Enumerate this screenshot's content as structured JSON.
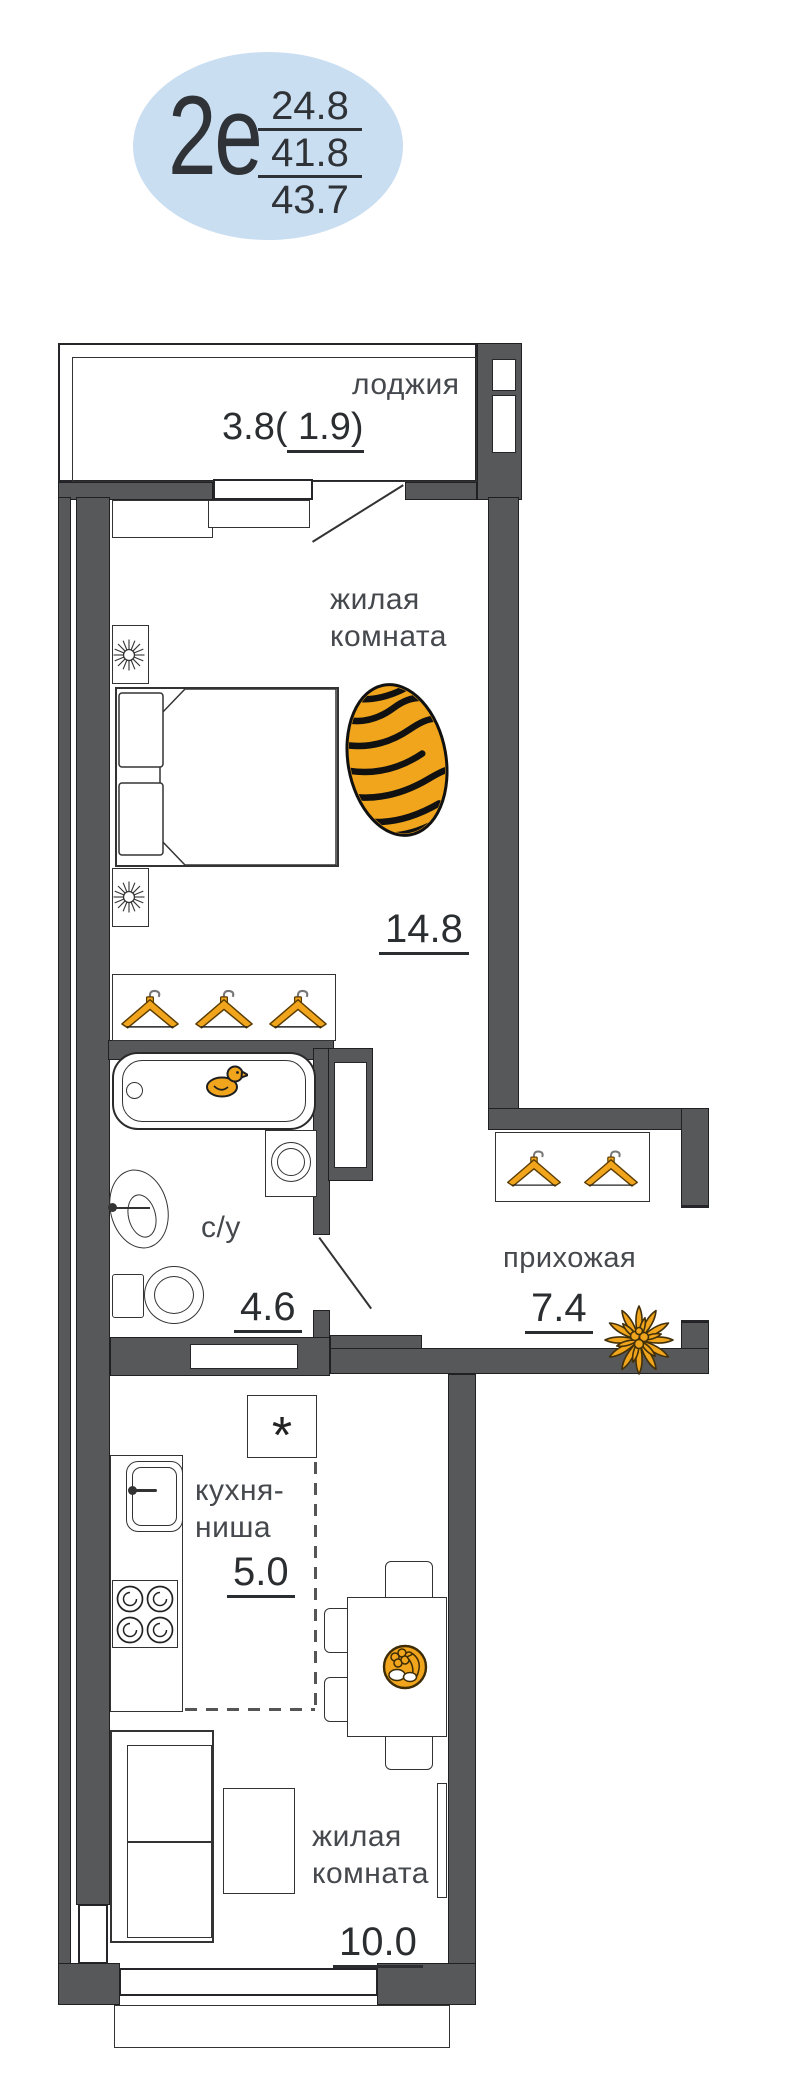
{
  "badge": {
    "type_label": "2е",
    "area_living": "24.8",
    "area_mid": "41.8",
    "area_total": "43.7"
  },
  "loggia": {
    "name": "лоджия",
    "area_prefix": "3.8(",
    "area_underlined": " 1.9)"
  },
  "living_top": {
    "name_line1": "жилая",
    "name_line2": "комната",
    "area": "14.8"
  },
  "bathroom": {
    "name": "с/у",
    "area": "4.6"
  },
  "hallway": {
    "name": "прихожая",
    "area": "7.4"
  },
  "kitchen": {
    "name_line1": "кухня-",
    "name_line2": "ниша",
    "area": "5.0",
    "note_symbol": "*"
  },
  "living_bottom": {
    "name_line1": "жилая",
    "name_line2": "комната",
    "area": "10.0"
  },
  "colors": {
    "wall": "#57585a",
    "accent_orange": "#f0a51c",
    "badge_bg": "#cadef2",
    "line": "#333333",
    "text": "#45494d",
    "num": "#2b2e31"
  }
}
